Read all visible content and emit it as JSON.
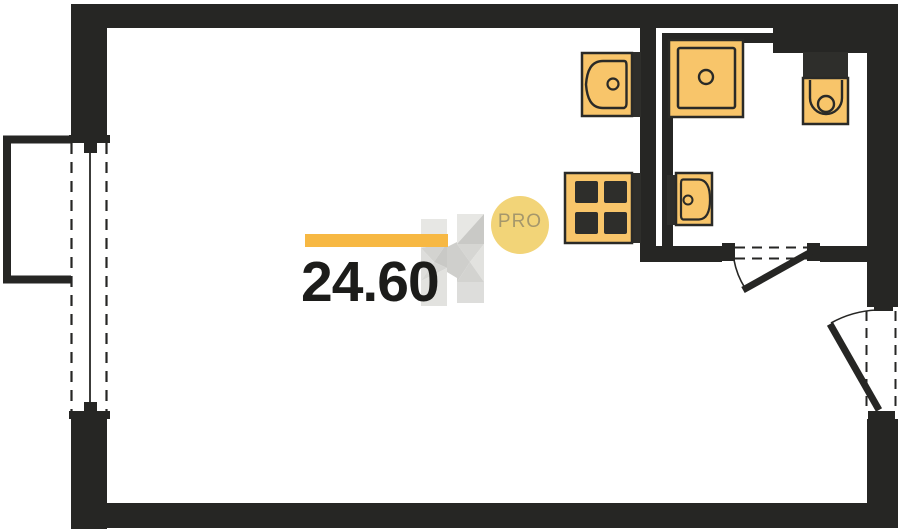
{
  "plan": {
    "type": "floor-plan",
    "area_label": "24.60",
    "fixtures": [
      "kitchen-sink",
      "stove",
      "shower",
      "bathroom-sink",
      "toilet"
    ],
    "openings": [
      "window-left",
      "bathroom-door",
      "entry-door"
    ],
    "features": [
      "balcony",
      "ventilation-shaft"
    ]
  },
  "watermark": {
    "logo": "h-logo",
    "badge_label": "PRO"
  },
  "colors": {
    "paper": "#ffffff",
    "wall": "#262624",
    "fixture": "#f8c56a",
    "fixture_stroke": "#2a2a27",
    "fixture_dark": "#2e2e2b",
    "accent": "#f7b843",
    "badge_bg": "#f2d478",
    "badge_text": "#a5976b",
    "ink": "#1c1c1a",
    "wm_1": "#e7e7e4",
    "wm_2": "#d3d3d0",
    "wm_3": "#c9c9c6",
    "wm_4": "#dddddb",
    "wm_5": "#d6d6d3",
    "wm_6": "#e2e2df",
    "wm_7": "#cfcfcc"
  }
}
